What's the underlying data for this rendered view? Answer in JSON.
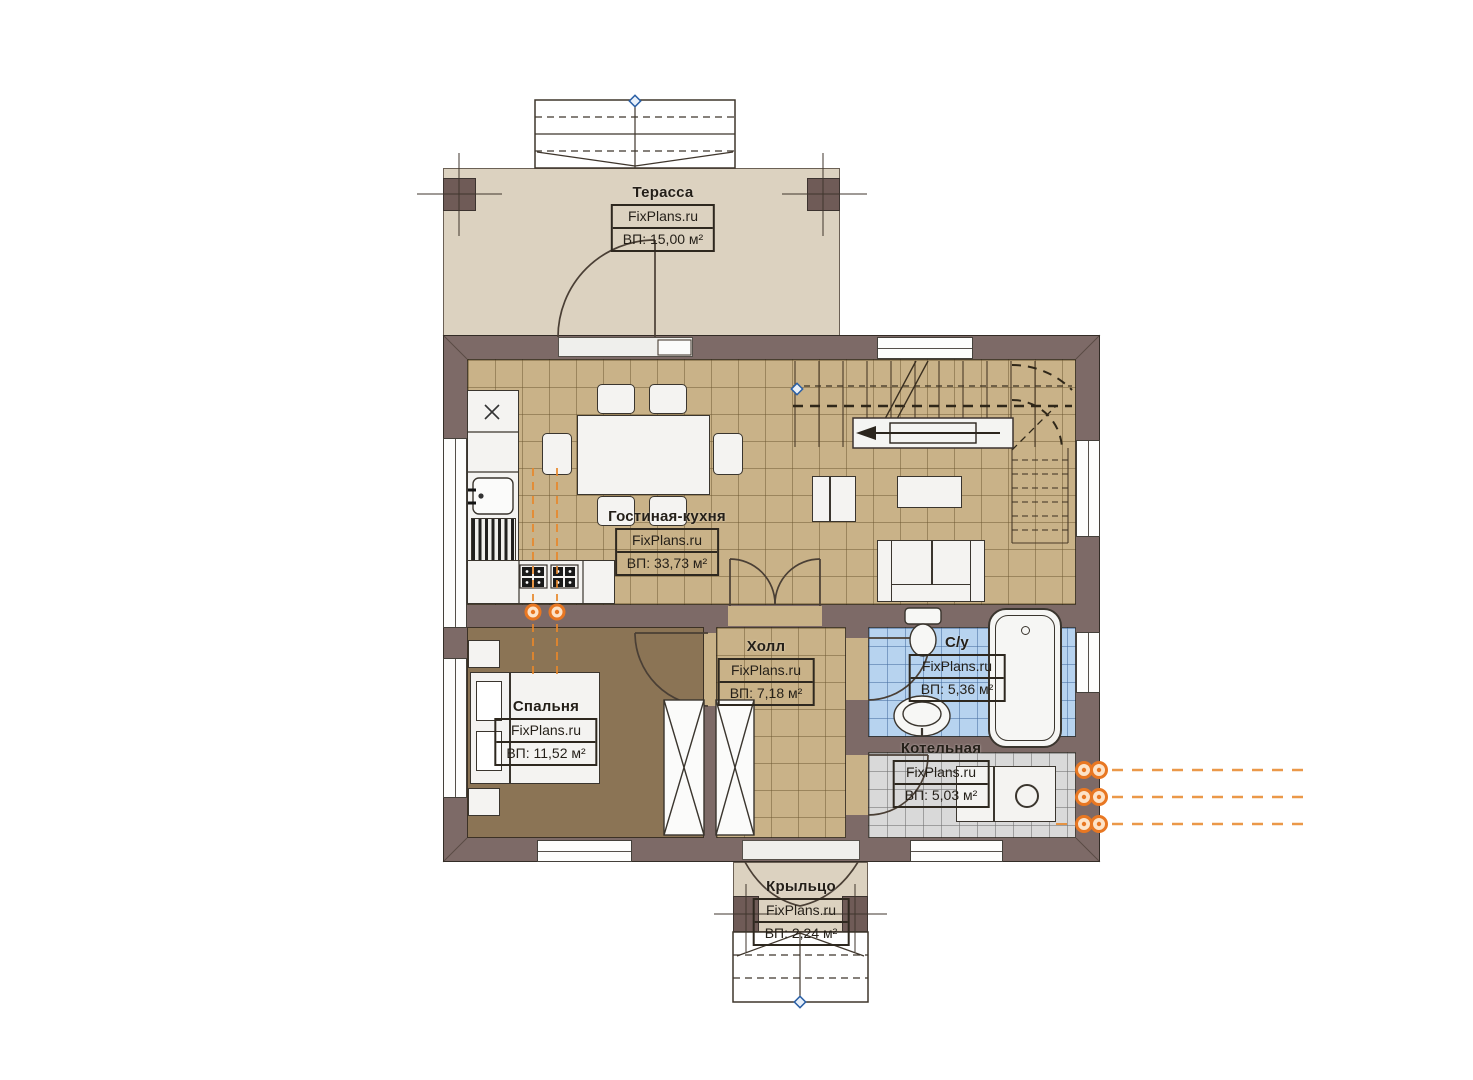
{
  "brand": "FixPlans.ru",
  "rooms": [
    {
      "id": "terrace",
      "name": "Терасса",
      "area": "ВП: 15,00 м²"
    },
    {
      "id": "living",
      "name": "Гостиная-кухня",
      "area": "ВП: 33,73 м²"
    },
    {
      "id": "hall",
      "name": "Холл",
      "area": "ВП: 7,18 м²"
    },
    {
      "id": "bathroom",
      "name": "С/у",
      "area": "ВП: 5,36 м²"
    },
    {
      "id": "bedroom",
      "name": "Спальня",
      "area": "ВП: 11,52 м²"
    },
    {
      "id": "boiler",
      "name": "Котельная",
      "area": "ВП: 5,03 м²"
    },
    {
      "id": "porch",
      "name": "Крыльцо",
      "area": "ВП: 2,24 м²"
    }
  ],
  "colors": {
    "wall": "#7d6a67",
    "floor_living_kitchen": "#c9b288",
    "floor_bedroom": "#8b7455",
    "floor_bathroom": "#b7d3ef",
    "floor_boiler": "#d9d9d9",
    "terrace_deck": "#dcd2c0",
    "radiator_accent": "#e87722",
    "datum_marker": "#2a5fa5"
  }
}
